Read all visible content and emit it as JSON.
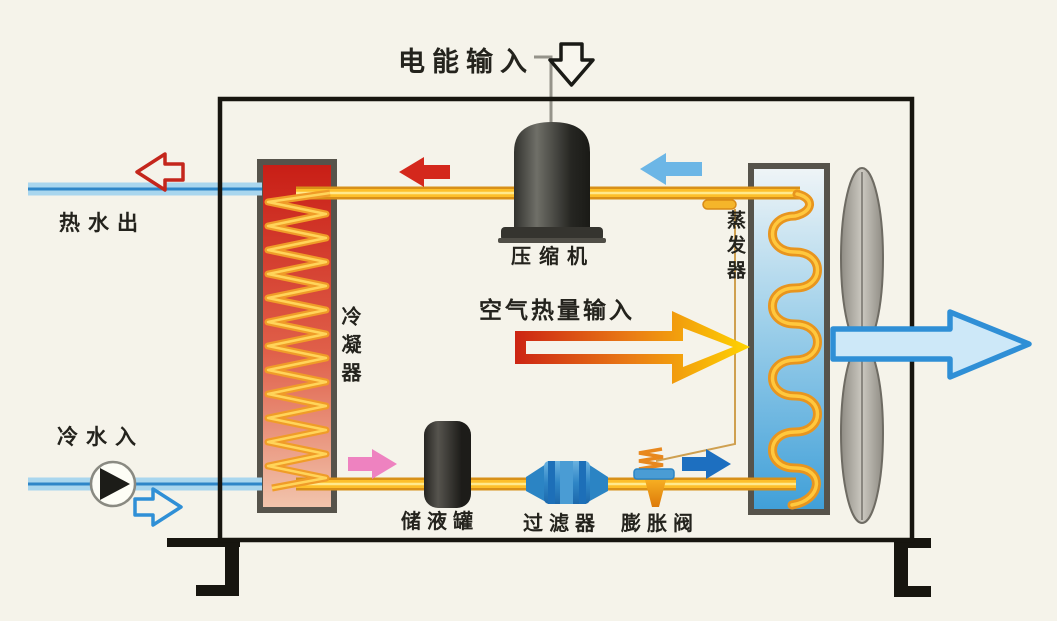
{
  "diagram": {
    "labels": {
      "electric_input": "电能输入",
      "compressor": "压缩机",
      "condenser": "冷凝器",
      "evaporator": "蒸发器",
      "air_heat_input": "空气热量输入",
      "hot_water_out": "热水出",
      "cold_water_in": "冷水入",
      "receiver_tank": "储液罐",
      "filter": "过滤器",
      "expansion_valve": "膨胀阀"
    },
    "icons": {
      "electric_input_arrow": "hollow-down-arrow",
      "hot_water_out_arrow": "hollow-left-arrow",
      "cold_water_in_arrow": "hollow-right-arrow",
      "discharge_flow_arrow": "solid-left-arrow",
      "suction_flow_arrow": "solid-left-arrow",
      "liquid_flow_arrow": "solid-right-arrow",
      "to_evaporator_arrow": "solid-right-arrow",
      "air_heat_arrow": "hollow-right-arrow-gradient",
      "air_out_arrow": "outlined-right-arrow",
      "pump": "circle-with-right-triangle",
      "fan": "two-blade-vertical-fan"
    },
    "colors": {
      "background": "#f5f3ea",
      "enclosure": "#17150f",
      "water_pipe": "#a9d6ee",
      "water_pipe_stripe": "#2e86c8",
      "refrigerant_pipe": "#fdbf2a",
      "condenser_top": "#c81d15",
      "condenser_bottom": "#f2c6ae",
      "evaporator_top": "#f0f5f7",
      "evaporator_bottom": "#3f9fd8",
      "coil": "#f09c28",
      "arrow_hot_out": "#c4261c",
      "arrow_discharge": "#d4281c",
      "arrow_suction": "#6cb6e6",
      "arrow_liquid": "#ee82c0",
      "arrow_to_evaporator": "#1d6fc0",
      "arrow_air_out_stroke": "#2f8fd6",
      "arrow_air_out_fill": "#cde8f8",
      "heat_arrow_start": "#cc2413",
      "heat_arrow_end": "#ffd400"
    }
  }
}
